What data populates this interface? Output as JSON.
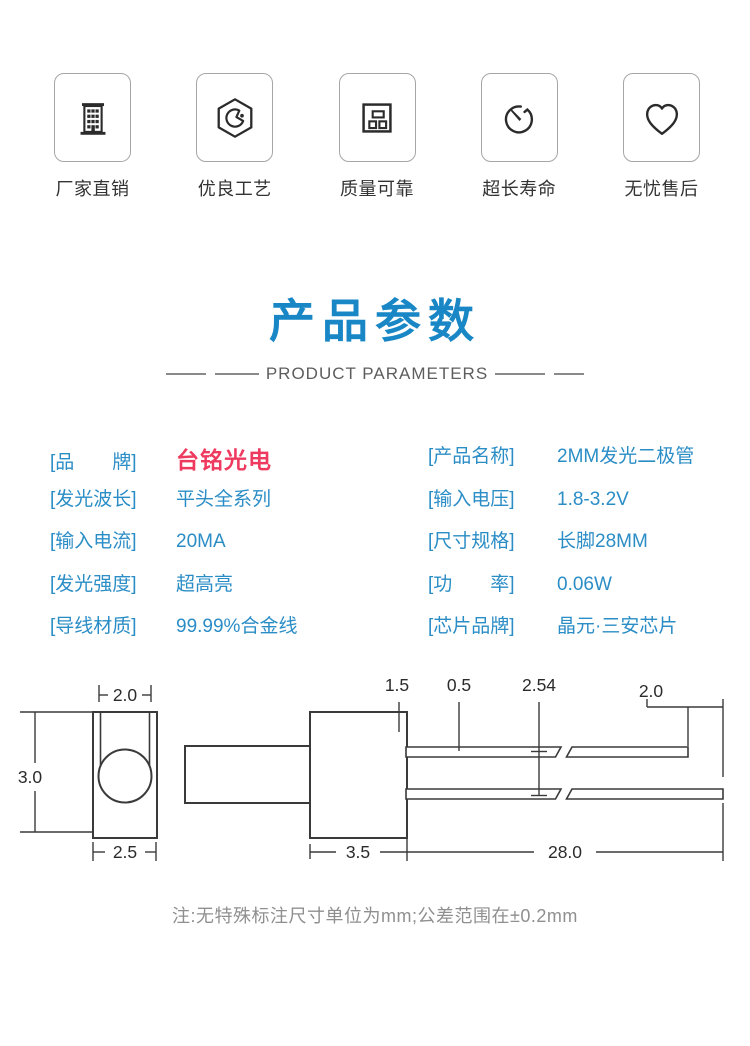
{
  "colors": {
    "accent_blue": "#1987c5",
    "param_blue": "#2b8dc6",
    "brand_red": "#ef3a5f",
    "drawing_stroke": "#3a3a3a",
    "note_gray": "#8f8f8f"
  },
  "features": [
    {
      "icon": "building-icon",
      "label": "厂家直销"
    },
    {
      "icon": "badge-icon",
      "label": "优良工艺"
    },
    {
      "icon": "components-icon",
      "label": "质量可靠"
    },
    {
      "icon": "timer-icon",
      "label": "超长寿命"
    },
    {
      "icon": "heart-icon",
      "label": "无忧售后"
    }
  ],
  "section": {
    "title": "产品参数",
    "subtitle": "PRODUCT PARAMETERS"
  },
  "parameters": {
    "left": [
      {
        "label": "[品　　牌]",
        "value": "台铭光电"
      },
      {
        "label": "[发光波长]",
        "value": "平头全系列"
      },
      {
        "label": "[输入电流]",
        "value": "20MA"
      },
      {
        "label": "[发光强度]",
        "value": "超高亮"
      },
      {
        "label": "[导线材质]",
        "value": "99.99%合金线"
      }
    ],
    "right": [
      {
        "label": "[产品名称]",
        "value": "2MM发光二极管"
      },
      {
        "label": "[输入电压]",
        "value": "1.8-3.2V"
      },
      {
        "label": "[尺寸规格]",
        "value": "长脚28MM"
      },
      {
        "label": "[功　　率]",
        "value": "0.06W"
      },
      {
        "label": "[芯片品牌]",
        "value": "晶元·三安芯片"
      }
    ]
  },
  "diagram": {
    "front_lens_width": "2.0",
    "front_height": "3.0",
    "front_width": "2.5",
    "lead_standoff": "1.5",
    "lead_thickness": "0.5",
    "lead_pitch": "2.54",
    "lead_tip_diff": "2.0",
    "body_length": "3.5",
    "lead_length": "28.0"
  },
  "note": "注:无特殊标注尺寸单位为mm;公差范围在±0.2mm"
}
